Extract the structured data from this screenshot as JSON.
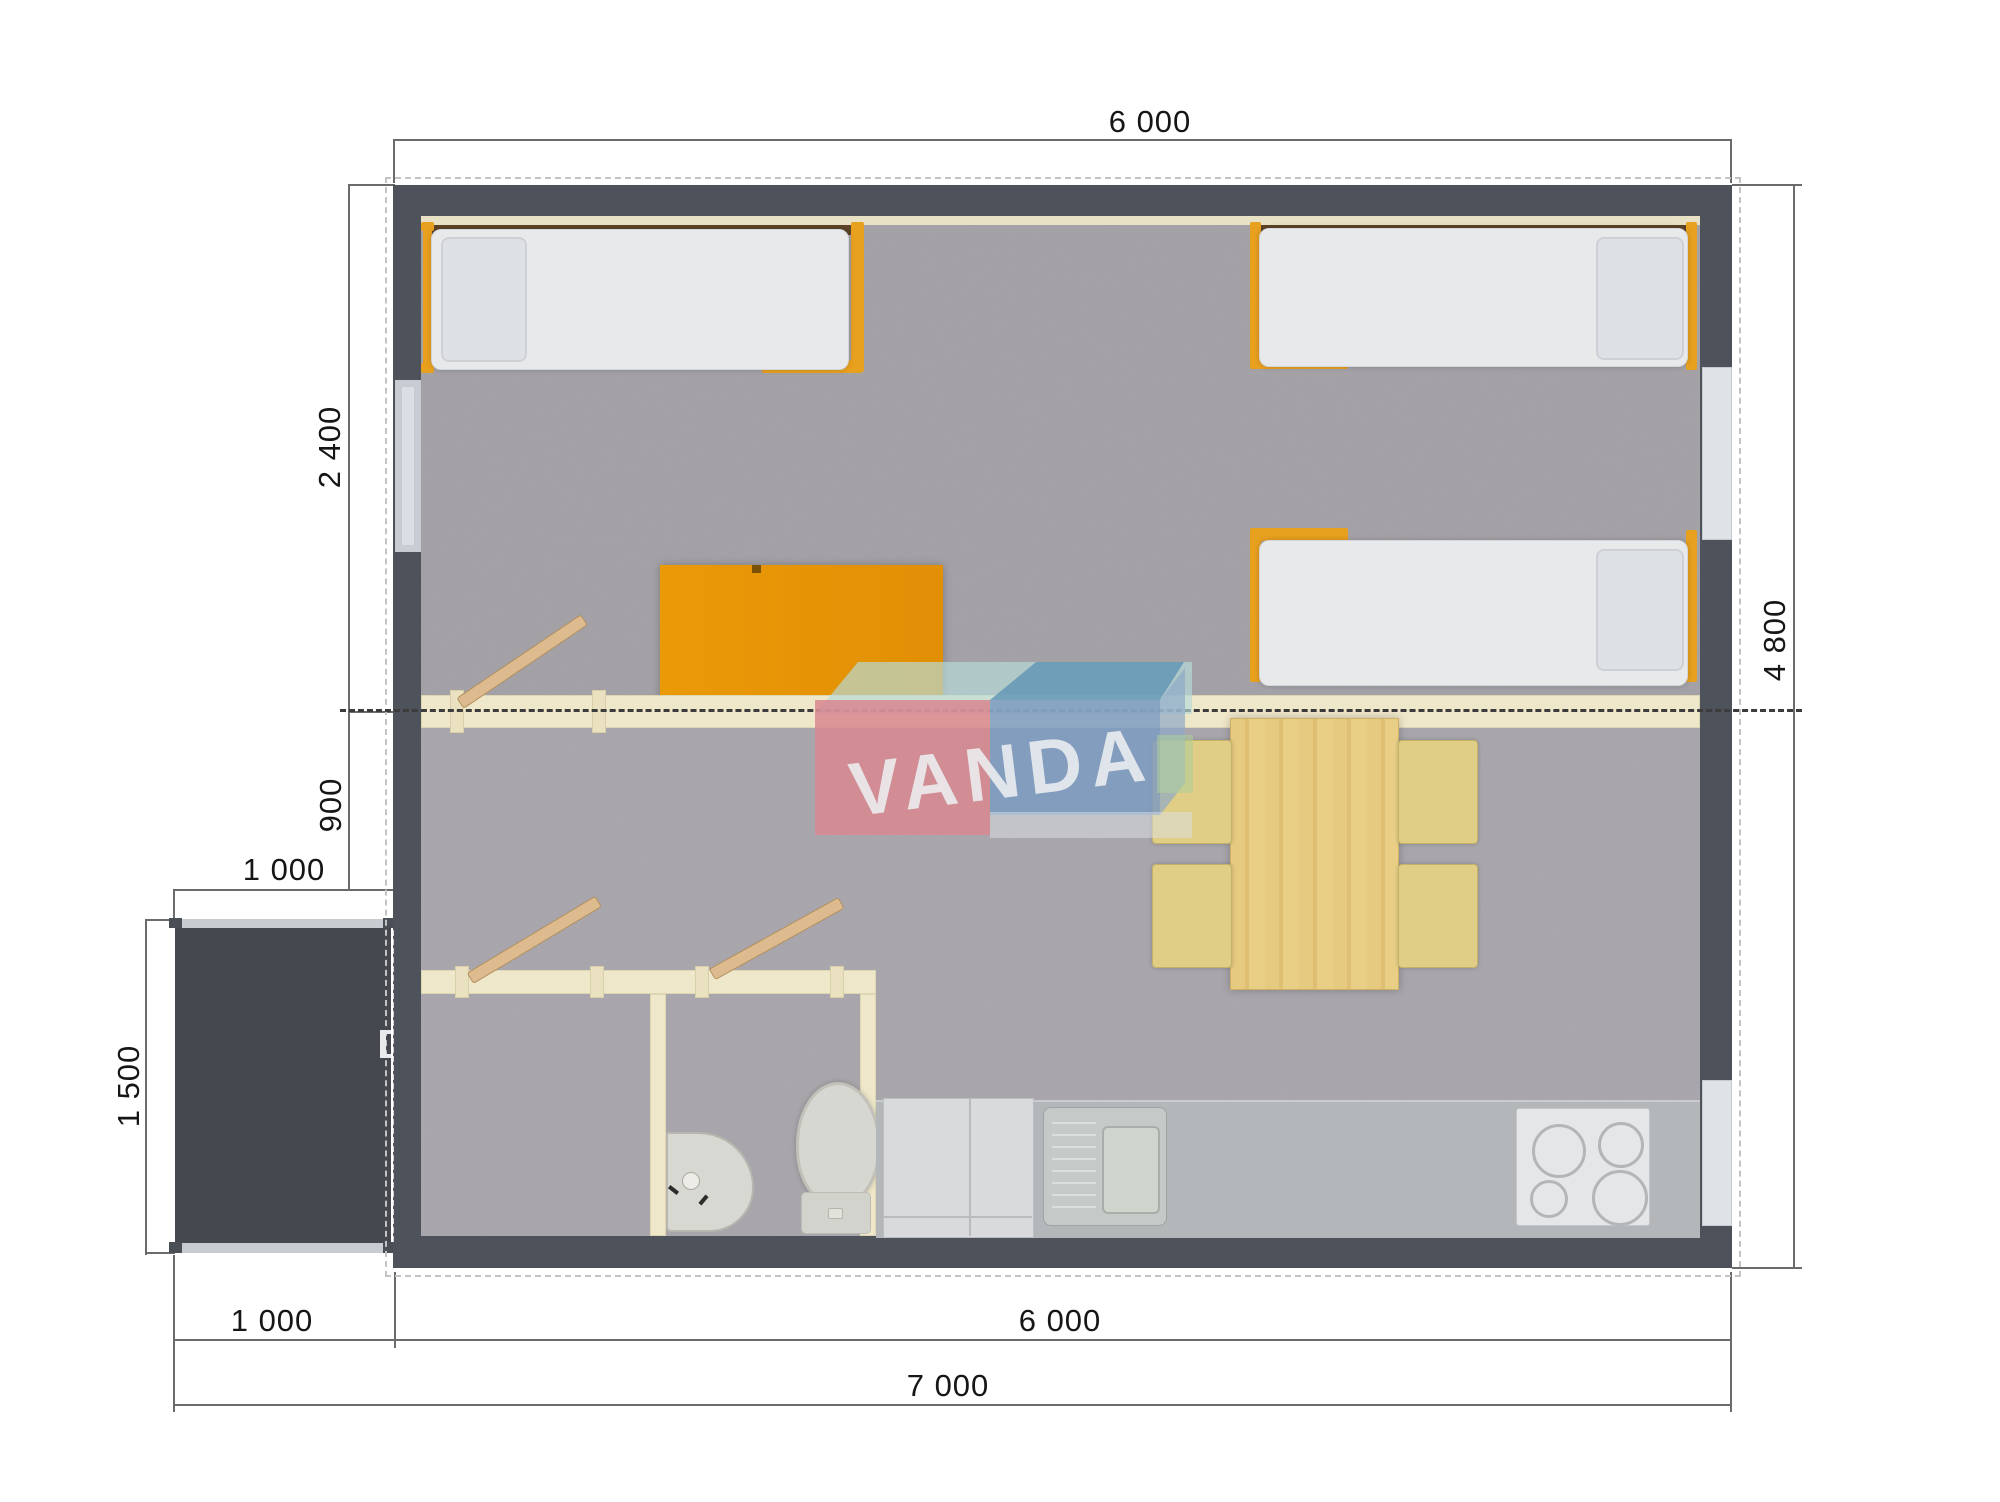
{
  "watermark": {
    "text": "VANDA"
  },
  "dims": {
    "top_width": "6 000",
    "bedroom_depth": "2 400",
    "hall_depth": "900",
    "porch_width": "1 000",
    "porch_depth": "1 500",
    "house_depth": "4 800",
    "bottom_porch_width": "1 000",
    "bottom_house_width": "6 000",
    "total_width": "7 000"
  },
  "colors": {
    "wall": "#4d525b",
    "porch": "#45494f",
    "floor": "#a9a7ac",
    "accent_orange": "#e89710",
    "bed_frame": "#e8a01f",
    "interior_wall": "#efe7ca",
    "logo_pink": "#d8878f",
    "logo_blue": "#7d9bc1",
    "logo_teal": "#b7dbd8",
    "counter": "#b4b7b9",
    "table_wood": "#e5c97e",
    "chair": "#e0cd86",
    "door_wood": "#ddbb8e"
  }
}
